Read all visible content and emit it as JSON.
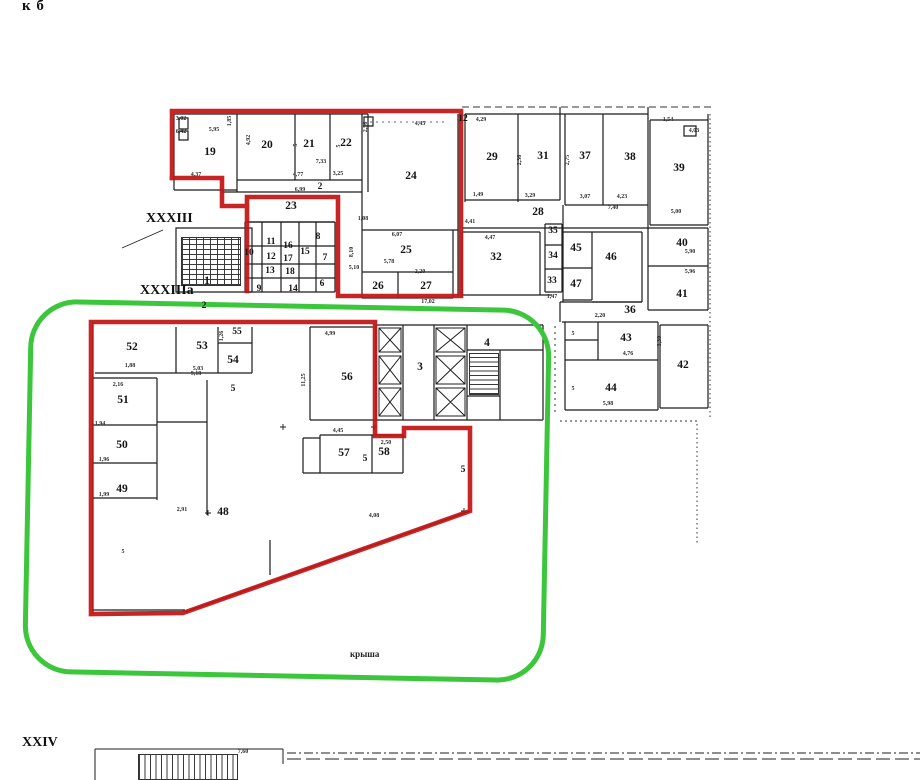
{
  "meta": {
    "corner_note": "к б",
    "axis_label_upper": "XXXIII",
    "axis_label_lower": "XXXIIIa",
    "axis_label_bottom": "XXIV",
    "roof_label": "крыша"
  },
  "colors": {
    "red_outline": "#c31515",
    "green_outline": "#3cc63c",
    "wall": "#1c1c1c",
    "paper": "#ffffff"
  },
  "rooms": [
    {
      "label": "19",
      "x": 210,
      "y": 152
    },
    {
      "label": "20",
      "x": 267,
      "y": 145
    },
    {
      "label": "21",
      "x": 309,
      "y": 144
    },
    {
      "label": "22",
      "x": 346,
      "y": 143
    },
    {
      "label": "24",
      "x": 411,
      "y": 176
    },
    {
      "label": "2",
      "x": 320,
      "y": 187,
      "s": "sm"
    },
    {
      "label": "23",
      "x": 291,
      "y": 206
    },
    {
      "label": "10",
      "x": 249,
      "y": 253,
      "s": "sm"
    },
    {
      "label": "11",
      "x": 271,
      "y": 242,
      "s": "sm"
    },
    {
      "label": "12",
      "x": 271,
      "y": 257,
      "s": "sm"
    },
    {
      "label": "13",
      "x": 270,
      "y": 271,
      "s": "sm"
    },
    {
      "label": "16",
      "x": 288,
      "y": 246,
      "s": "sm"
    },
    {
      "label": "17",
      "x": 288,
      "y": 259,
      "s": "sm"
    },
    {
      "label": "18",
      "x": 290,
      "y": 272,
      "s": "sm"
    },
    {
      "label": "15",
      "x": 305,
      "y": 252,
      "s": "sm"
    },
    {
      "label": "8",
      "x": 318,
      "y": 237,
      "s": "sm"
    },
    {
      "label": "7",
      "x": 325,
      "y": 258,
      "s": "sm"
    },
    {
      "label": "6",
      "x": 322,
      "y": 284,
      "s": "sm"
    },
    {
      "label": "9",
      "x": 259,
      "y": 289,
      "s": "sm"
    },
    {
      "label": "14",
      "x": 293,
      "y": 289,
      "s": "sm"
    },
    {
      "label": "1",
      "x": 207,
      "y": 281
    },
    {
      "label": "2",
      "x": 204,
      "y": 306,
      "s": "sm"
    },
    {
      "label": "25",
      "x": 406,
      "y": 250
    },
    {
      "label": "26",
      "x": 378,
      "y": 286
    },
    {
      "label": "27",
      "x": 426,
      "y": 286
    },
    {
      "label": "29",
      "x": 492,
      "y": 157
    },
    {
      "label": "31",
      "x": 543,
      "y": 156
    },
    {
      "label": "37",
      "x": 585,
      "y": 156
    },
    {
      "label": "38",
      "x": 630,
      "y": 157
    },
    {
      "label": "39",
      "x": 679,
      "y": 168
    },
    {
      "label": "28",
      "x": 538,
      "y": 212
    },
    {
      "label": "32",
      "x": 496,
      "y": 257
    },
    {
      "label": "35",
      "x": 553,
      "y": 231,
      "s": "sm"
    },
    {
      "label": "34",
      "x": 553,
      "y": 256,
      "s": "sm"
    },
    {
      "label": "33",
      "x": 552,
      "y": 281,
      "s": "sm"
    },
    {
      "label": "45",
      "x": 576,
      "y": 248
    },
    {
      "label": "46",
      "x": 611,
      "y": 257
    },
    {
      "label": "47",
      "x": 576,
      "y": 284
    },
    {
      "label": "40",
      "x": 682,
      "y": 243
    },
    {
      "label": "41",
      "x": 682,
      "y": 294
    },
    {
      "label": "36",
      "x": 630,
      "y": 310
    },
    {
      "label": "43",
      "x": 626,
      "y": 338
    },
    {
      "label": "42",
      "x": 683,
      "y": 365
    },
    {
      "label": "44",
      "x": 611,
      "y": 388
    },
    {
      "label": "52",
      "x": 132,
      "y": 347
    },
    {
      "label": "53",
      "x": 202,
      "y": 346
    },
    {
      "label": "55",
      "x": 237,
      "y": 332,
      "s": "sm"
    },
    {
      "label": "54",
      "x": 233,
      "y": 360
    },
    {
      "label": "51",
      "x": 123,
      "y": 400
    },
    {
      "label": "56",
      "x": 347,
      "y": 377
    },
    {
      "label": "3",
      "x": 420,
      "y": 367
    },
    {
      "label": "4",
      "x": 487,
      "y": 343
    },
    {
      "label": "50",
      "x": 122,
      "y": 445
    },
    {
      "label": "49",
      "x": 122,
      "y": 489
    },
    {
      "label": "48",
      "x": 223,
      "y": 512
    },
    {
      "label": "57",
      "x": 344,
      "y": 453
    },
    {
      "label": "58",
      "x": 384,
      "y": 452
    },
    {
      "label": "5",
      "x": 233,
      "y": 389,
      "s": "sm"
    },
    {
      "label": "5",
      "x": 365,
      "y": 459,
      "s": "sm"
    },
    {
      "label": "5",
      "x": 463,
      "y": 470,
      "s": "sm"
    },
    {
      "label": "12",
      "x": 463,
      "y": 119,
      "s": "sm"
    }
  ],
  "dims": [
    {
      "t": "3,02",
      "x": 181,
      "y": 119
    },
    {
      "t": "6,42",
      "x": 181,
      "y": 132
    },
    {
      "t": "5,95",
      "x": 214,
      "y": 130
    },
    {
      "t": "1,85",
      "x": 230,
      "y": 121,
      "r": 90
    },
    {
      "t": "4,92",
      "x": 249,
      "y": 140,
      "r": 90
    },
    {
      "t": "4,37",
      "x": 196,
      "y": 175
    },
    {
      "t": "7,33",
      "x": 321,
      "y": 162
    },
    {
      "t": "4,77",
      "x": 298,
      "y": 175
    },
    {
      "t": "3,25",
      "x": 338,
      "y": 174
    },
    {
      "t": "5",
      "x": 296,
      "y": 145,
      "r": 90
    },
    {
      "t": "5",
      "x": 339,
      "y": 146,
      "r": 90
    },
    {
      "t": "2,56",
      "x": 366,
      "y": 127,
      "r": 90
    },
    {
      "t": "4,45",
      "x": 420,
      "y": 124
    },
    {
      "t": "8,10",
      "x": 352,
      "y": 252,
      "r": 90
    },
    {
      "t": "6,07",
      "x": 397,
      "y": 235
    },
    {
      "t": "1,08",
      "x": 363,
      "y": 219
    },
    {
      "t": "6,99",
      "x": 300,
      "y": 190
    },
    {
      "t": "5,78",
      "x": 389,
      "y": 262
    },
    {
      "t": "5,10",
      "x": 354,
      "y": 268
    },
    {
      "t": "2,20",
      "x": 420,
      "y": 272
    },
    {
      "t": "17,02",
      "x": 428,
      "y": 302
    },
    {
      "t": "4,29",
      "x": 481,
      "y": 120
    },
    {
      "t": "1,49",
      "x": 478,
      "y": 195
    },
    {
      "t": "4,41",
      "x": 470,
      "y": 222
    },
    {
      "t": "3,29",
      "x": 530,
      "y": 196
    },
    {
      "t": "2,36",
      "x": 520,
      "y": 160,
      "r": 90
    },
    {
      "t": "4,47",
      "x": 490,
      "y": 238
    },
    {
      "t": "3,07",
      "x": 585,
      "y": 197
    },
    {
      "t": "4,23",
      "x": 622,
      "y": 197
    },
    {
      "t": "7,40",
      "x": 613,
      "y": 208
    },
    {
      "t": "2,75",
      "x": 568,
      "y": 160,
      "r": 90
    },
    {
      "t": "1,54",
      "x": 668,
      "y": 120
    },
    {
      "t": "4,03",
      "x": 694,
      "y": 131
    },
    {
      "t": "5,00",
      "x": 676,
      "y": 212
    },
    {
      "t": "5,90",
      "x": 690,
      "y": 252
    },
    {
      "t": "5,96",
      "x": 690,
      "y": 272
    },
    {
      "t": "1,47",
      "x": 552,
      "y": 297
    },
    {
      "t": "2,20",
      "x": 600,
      "y": 316
    },
    {
      "t": "3,30",
      "x": 660,
      "y": 341,
      "r": 90
    },
    {
      "t": "4,76",
      "x": 628,
      "y": 354
    },
    {
      "t": "5",
      "x": 573,
      "y": 334
    },
    {
      "t": "5",
      "x": 573,
      "y": 389
    },
    {
      "t": "5,98",
      "x": 608,
      "y": 404
    },
    {
      "t": "1,88",
      "x": 130,
      "y": 366
    },
    {
      "t": "5,03",
      "x": 198,
      "y": 369
    },
    {
      "t": "1,26",
      "x": 222,
      "y": 336,
      "r": 90
    },
    {
      "t": "2,16",
      "x": 118,
      "y": 385
    },
    {
      "t": "1,94",
      "x": 100,
      "y": 424
    },
    {
      "t": "1,96",
      "x": 104,
      "y": 460
    },
    {
      "t": "1,99",
      "x": 104,
      "y": 495
    },
    {
      "t": "4,99",
      "x": 330,
      "y": 334
    },
    {
      "t": "11,25",
      "x": 304,
      "y": 380,
      "r": 90
    },
    {
      "t": "9,18",
      "x": 196,
      "y": 374
    },
    {
      "t": "4,45",
      "x": 338,
      "y": 431
    },
    {
      "t": "2,50",
      "x": 386,
      "y": 443
    },
    {
      "t": "4,08",
      "x": 374,
      "y": 516
    },
    {
      "t": "2,91",
      "x": 182,
      "y": 510
    },
    {
      "t": "5",
      "x": 123,
      "y": 552
    },
    {
      "t": "7,60",
      "x": 243,
      "y": 752
    }
  ]
}
